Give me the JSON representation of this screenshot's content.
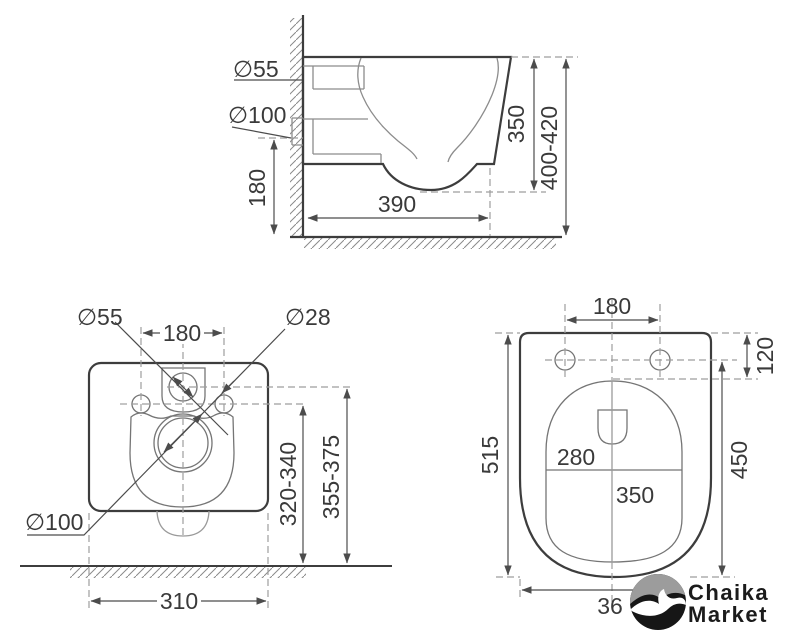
{
  "drawing": {
    "title": "wall-hung-toilet installation drawing, three orthographic views",
    "side_view": {
      "inlet_dia": "∅55",
      "outlet_dia": "∅100",
      "outlet_height": "180",
      "depth": "390",
      "body_height": "350",
      "mount_height": "400-420"
    },
    "rear_view": {
      "inlet_dia": "∅55",
      "hole_spacing": "180",
      "bolt_dia": "∅28",
      "outlet_dia": "∅100",
      "bolt_height": "320-340",
      "inlet_height": "355-375",
      "body_width": "310"
    },
    "plan_view": {
      "seat_hole_spacing": "180",
      "seat_hole_offset": "120",
      "total_length": "515",
      "bowl_width": "280",
      "bowl_depth": "350",
      "front_length": "450",
      "bottom_width_partial": "36"
    },
    "logo": {
      "line1": "Chaika",
      "line2": "Market"
    },
    "colors": {
      "outline": "#3d3d3d",
      "thin_line": "#8c8c8c",
      "dashed_line": "#9e9e9e",
      "dimension": "#4c4c4c",
      "logo_gray": "#9c9c9c",
      "logo_black": "#161616"
    }
  }
}
